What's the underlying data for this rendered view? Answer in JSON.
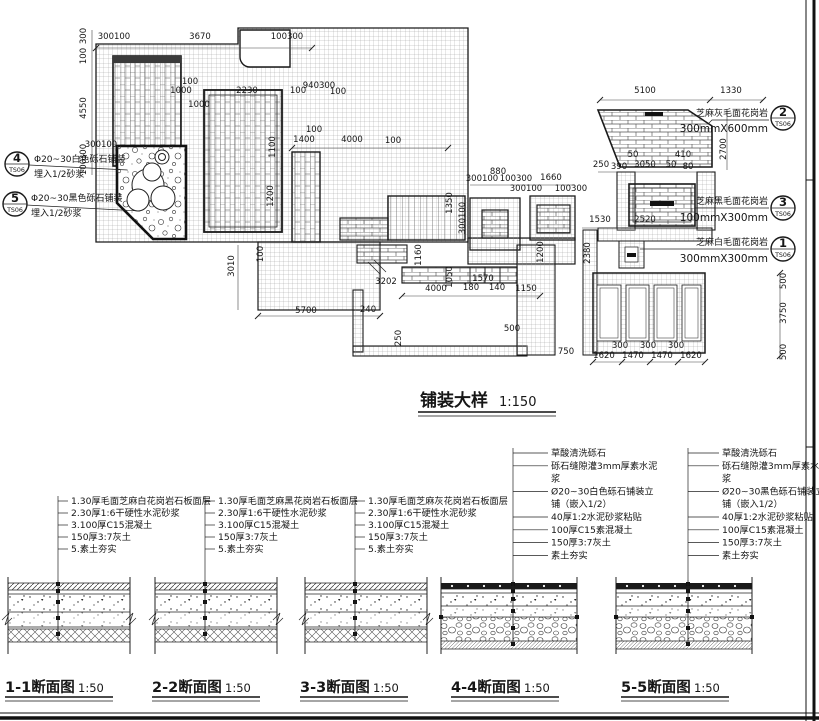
{
  "plan": {
    "title": "铺装大样",
    "scale": "1:150",
    "callouts": [
      {
        "num": "4",
        "ref": "TS06",
        "lines": [
          "Φ20~30白色砾石铺装",
          "埋入1/2砂浆"
        ]
      },
      {
        "num": "5",
        "ref": "TS06",
        "lines": [
          "Φ20~30黑色砾石铺装",
          "埋入1/2砂浆"
        ]
      },
      {
        "num": "2",
        "ref": "TS06",
        "lines": [
          "芝麻灰毛面花岗岩",
          "300mmX600mm"
        ]
      },
      {
        "num": "3",
        "ref": "TS06",
        "lines": [
          "芝麻黑毛面花岗岩",
          "100mmX300mm"
        ]
      },
      {
        "num": "1",
        "ref": "TS06",
        "lines": [
          "芝麻白毛面花岗岩",
          "300mmX300mm"
        ]
      }
    ],
    "dimensions": [
      {
        "t": "300100",
        "x": 114,
        "y": 39
      },
      {
        "t": "3670",
        "x": 200,
        "y": 39
      },
      {
        "t": "100300",
        "x": 287,
        "y": 39
      },
      {
        "t": "300",
        "x": 86,
        "y": 36,
        "r": 1
      },
      {
        "t": "100",
        "x": 86,
        "y": 56,
        "r": 1
      },
      {
        "t": "4550",
        "x": 86,
        "y": 108,
        "r": 1
      },
      {
        "t": "300",
        "x": 86,
        "y": 152,
        "r": 1
      },
      {
        "t": "100",
        "x": 86,
        "y": 167,
        "r": 1
      },
      {
        "t": "100",
        "x": 190,
        "y": 84
      },
      {
        "t": "1000",
        "x": 181,
        "y": 93
      },
      {
        "t": "2230",
        "x": 247,
        "y": 93
      },
      {
        "t": "940300",
        "x": 319,
        "y": 88
      },
      {
        "t": "100",
        "x": 298,
        "y": 93
      },
      {
        "t": "100",
        "x": 338,
        "y": 94
      },
      {
        "t": "1000",
        "x": 199,
        "y": 107
      },
      {
        "t": "300100",
        "x": 101,
        "y": 147
      },
      {
        "t": "1100",
        "x": 275,
        "y": 147,
        "r": 1
      },
      {
        "t": "1200",
        "x": 273,
        "y": 196,
        "r": 1
      },
      {
        "t": "100",
        "x": 314,
        "y": 132
      },
      {
        "t": "1400",
        "x": 304,
        "y": 142
      },
      {
        "t": "4000",
        "x": 352,
        "y": 142
      },
      {
        "t": "100",
        "x": 393,
        "y": 143
      },
      {
        "t": "3010",
        "x": 234,
        "y": 266,
        "r": 1
      },
      {
        "t": "100",
        "x": 263,
        "y": 254,
        "r": 1
      },
      {
        "t": "5700",
        "x": 306,
        "y": 313
      },
      {
        "t": "240",
        "x": 368,
        "y": 312
      },
      {
        "t": "250",
        "x": 401,
        "y": 338,
        "r": 1
      },
      {
        "t": "3202",
        "x": 386,
        "y": 284
      },
      {
        "t": "1160",
        "x": 421,
        "y": 255,
        "r": 1
      },
      {
        "t": "4000",
        "x": 436,
        "y": 291
      },
      {
        "t": "180",
        "x": 471,
        "y": 290
      },
      {
        "t": "140",
        "x": 497,
        "y": 290
      },
      {
        "t": "1150",
        "x": 526,
        "y": 291
      },
      {
        "t": "500",
        "x": 512,
        "y": 331
      },
      {
        "t": "1050",
        "x": 452,
        "y": 277,
        "r": 1
      },
      {
        "t": "1570",
        "x": 483,
        "y": 281
      },
      {
        "t": "1200",
        "x": 543,
        "y": 252,
        "r": 1
      },
      {
        "t": "880",
        "x": 498,
        "y": 174
      },
      {
        "t": "300100",
        "x": 482,
        "y": 181
      },
      {
        "t": "100300",
        "x": 516,
        "y": 181
      },
      {
        "t": "1660",
        "x": 551,
        "y": 180
      },
      {
        "t": "300100",
        "x": 526,
        "y": 191
      },
      {
        "t": "100300",
        "x": 571,
        "y": 191
      },
      {
        "t": "1350",
        "x": 452,
        "y": 203,
        "r": 1
      },
      {
        "t": "300100",
        "x": 465,
        "y": 218,
        "r": 1
      },
      {
        "t": "1530",
        "x": 600,
        "y": 222
      },
      {
        "t": "2380",
        "x": 590,
        "y": 253,
        "r": 1
      },
      {
        "t": "2520",
        "x": 645,
        "y": 222
      },
      {
        "t": "5100",
        "x": 645,
        "y": 93
      },
      {
        "t": "1330",
        "x": 731,
        "y": 93
      },
      {
        "t": "2700",
        "x": 726,
        "y": 149,
        "r": 1
      },
      {
        "t": "250",
        "x": 601,
        "y": 167
      },
      {
        "t": "390",
        "x": 619,
        "y": 169
      },
      {
        "t": "3050",
        "x": 645,
        "y": 167
      },
      {
        "t": "50",
        "x": 671,
        "y": 167
      },
      {
        "t": "80",
        "x": 688,
        "y": 169
      },
      {
        "t": "410",
        "x": 683,
        "y": 157
      },
      {
        "t": "50",
        "x": 633,
        "y": 157
      },
      {
        "t": "1620",
        "x": 604,
        "y": 358
      },
      {
        "t": "1470",
        "x": 633,
        "y": 358
      },
      {
        "t": "1470",
        "x": 662,
        "y": 358
      },
      {
        "t": "1620",
        "x": 691,
        "y": 358
      },
      {
        "t": "300",
        "x": 620,
        "y": 348
      },
      {
        "t": "300",
        "x": 648,
        "y": 348
      },
      {
        "t": "300",
        "x": 676,
        "y": 348
      },
      {
        "t": "500",
        "x": 786,
        "y": 281,
        "r": 1
      },
      {
        "t": "3750",
        "x": 786,
        "y": 313,
        "r": 1
      },
      {
        "t": "500",
        "x": 786,
        "y": 352,
        "r": 1
      },
      {
        "t": "750",
        "x": 566,
        "y": 354
      }
    ]
  },
  "sections": [
    {
      "title": "1-1断面图",
      "scale": "1:50",
      "notes": [
        {
          "t": "1.30厚毛面芝麻白花岗岩石板面层",
          "tick": 1
        },
        {
          "t": "2.30厚1:6干硬性水泥砂浆",
          "tick": 1
        },
        {
          "t": "3.100厚C15混凝土",
          "tick": 1
        },
        {
          "t": "150厚3:7灰土",
          "tick": 1
        },
        {
          "t": "5.素土夯实",
          "tick": 1
        }
      ]
    },
    {
      "title": "2-2断面图",
      "scale": "1:50",
      "notes": [
        {
          "t": "1.30厚毛面芝麻黑花岗岩石板面层",
          "tick": 1
        },
        {
          "t": "2.30厚1:6干硬性水泥砂浆",
          "tick": 1
        },
        {
          "t": "3.100厚C15混凝土",
          "tick": 1
        },
        {
          "t": "150厚3:7灰土",
          "tick": 1
        },
        {
          "t": "5.素土夯实",
          "tick": 1
        }
      ]
    },
    {
      "title": "3-3断面图",
      "scale": "1:50",
      "notes": [
        {
          "t": "1.30厚毛面芝麻灰花岗岩石板面层",
          "tick": 1
        },
        {
          "t": "2.30厚1:6干硬性水泥砂浆",
          "tick": 1
        },
        {
          "t": "3.100厚C15混凝土",
          "tick": 1
        },
        {
          "t": "150厚3:7灰土",
          "tick": 1
        },
        {
          "t": "5.素土夯实",
          "tick": 1
        }
      ]
    },
    {
      "title": "4-4断面图",
      "scale": "1:50",
      "notes": [
        {
          "t": "草酸清洗砾石",
          "tick": 1
        },
        {
          "t": "砾石缝隙灌3mm厚素水泥",
          "tick": 1
        },
        {
          "t": "浆",
          "tick": 0
        },
        {
          "t": "Ø20~30白色砾石铺装立",
          "tick": 1
        },
        {
          "t": "铺（嵌入1/2）",
          "tick": 0
        },
        {
          "t": "40厚1:2水泥砂浆粘贴",
          "tick": 1
        },
        {
          "t": "100厚C15素混凝土",
          "tick": 1
        },
        {
          "t": "150厚3:7灰土",
          "tick": 1
        },
        {
          "t": "素土夯实",
          "tick": 1
        }
      ]
    },
    {
      "title": "5-5断面图",
      "scale": "1:50",
      "notes": [
        {
          "t": "草酸清洗砾石",
          "tick": 1
        },
        {
          "t": "砾石缝隙灌3mm厚素水泥",
          "tick": 1
        },
        {
          "t": "浆",
          "tick": 0
        },
        {
          "t": "Ø20~30黑色砾石铺装立",
          "tick": 1
        },
        {
          "t": "铺（嵌入1/2）",
          "tick": 0
        },
        {
          "t": "40厚1:2水泥砂浆粘贴",
          "tick": 1
        },
        {
          "t": "100厚C15素混凝土",
          "tick": 1
        },
        {
          "t": "150厚3:7灰土",
          "tick": 1
        },
        {
          "t": "素土夯实",
          "tick": 1
        }
      ]
    }
  ]
}
